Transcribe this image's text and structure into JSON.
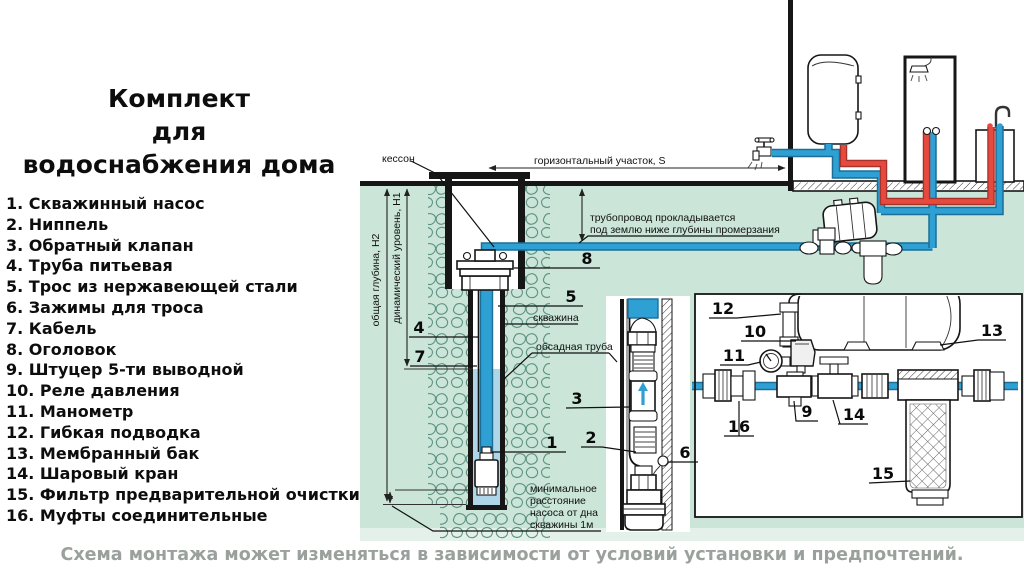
{
  "title": "Комплект\nдля\nводоснабжения дома",
  "legend": {
    "items": [
      {
        "text": "1. Скважинный насос"
      },
      {
        "text": "2. Ниппель"
      },
      {
        "text": "3. Обратный клапан"
      },
      {
        "text": "4. Труба питьевая"
      },
      {
        "text": "5. Трос из нержавеющей стали"
      },
      {
        "text": "6. Зажимы для троса"
      },
      {
        "text": "7. Кабель"
      },
      {
        "text": "8. Оголовок"
      },
      {
        "text": "9. Штуцер 5-ти выводной"
      },
      {
        "text": "10. Реле давления"
      },
      {
        "text": "11. Манометр"
      },
      {
        "text": "12. Гибкая подводка"
      },
      {
        "text": "13. Мембранный бак"
      },
      {
        "text": "14. Шаровый кран"
      },
      {
        "text": "15. Фильтр предварительной очистки"
      },
      {
        "text": "16. Муфты соединительные"
      }
    ]
  },
  "footer": {
    "note": "Схема монтажа может изменяться в зависимости от условий установки и предпочтений."
  },
  "diagram": {
    "labels": {
      "kesson": "кессон",
      "horizontal_section": "горизонтальный участок, S",
      "pipeline_line1": "трубопровод прокладывается",
      "pipeline_line2": "под землю ниже глубины промерзания",
      "total_depth": "общая глубина, Н2",
      "dynamic_level": "динамический уровень, Н1",
      "borehole": "скважина",
      "casing_pipe": "обсадная труба",
      "min_dist_line1": "минимальное",
      "min_dist_line2": "расстояние",
      "min_dist_line3": "насоса от дна",
      "min_dist_line4": "скважины 1м"
    },
    "callouts": {
      "n1": "1",
      "n2": "2",
      "n3": "3",
      "n4": "4",
      "n5": "5",
      "n6": "6",
      "n7": "7",
      "n8": "8",
      "n9": "9",
      "n10": "10",
      "n11": "11",
      "n12": "12",
      "n13": "13",
      "n14": "14",
      "n15": "15",
      "n16": "16"
    },
    "colors": {
      "ground_green": "#cbe5d8",
      "water_blue": "#aed6e8",
      "cold_pipe": "#2fa0d3",
      "hot_pipe": "#e64a3f",
      "stone_outline": "#5d9384"
    }
  }
}
